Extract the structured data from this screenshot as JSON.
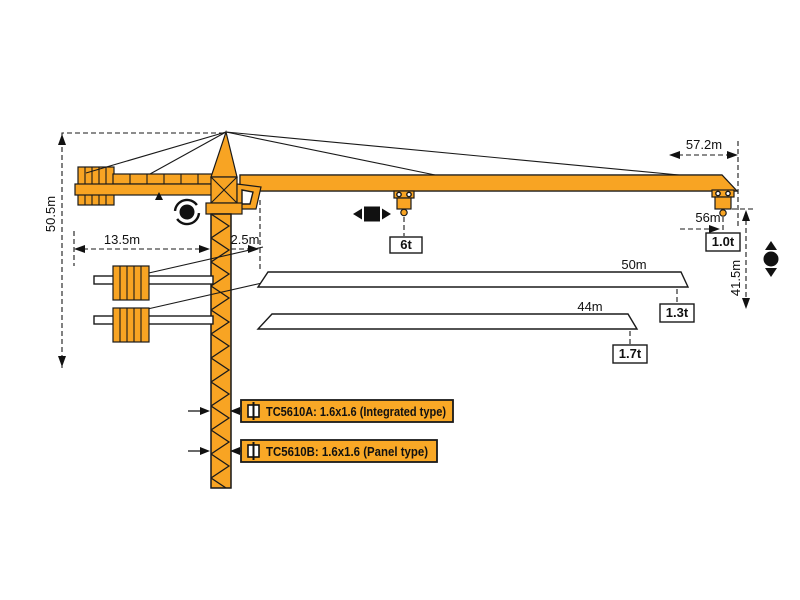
{
  "diagram_title": "TC5610 tower crane working range diagram",
  "colors": {
    "crane_orange": "#F8A423",
    "label_orange": "#F9A826",
    "line_black": "#1a1a1a",
    "background": "#ffffff"
  },
  "dimensions": {
    "total_height": "50.5m",
    "counter_jib_length": "13.5m",
    "jib_root_offset": "2.5m",
    "max_radius": "57.2m",
    "max_hook_radius": "56m",
    "hook_height": "41.5m"
  },
  "capacities": {
    "mid_span": "6t",
    "at_tip_56m": "1.0t"
  },
  "jib_options": [
    {
      "length": "50m",
      "tip_capacity": "1.3t"
    },
    {
      "length": "44m",
      "tip_capacity": "1.7t"
    }
  ],
  "mast_sections": [
    {
      "label": "TC5610A: 1.6x1.6 (Integrated type)"
    },
    {
      "label": "TC5610B: 1.6x1.6 (Panel type)"
    }
  ],
  "icons": {
    "slewing": "rotation-arrows-around-dot",
    "trolley_travel": "left-right-arrows-square",
    "hoisting": "up-down-arrows-dot",
    "mast_section": "square-with-center-line"
  }
}
